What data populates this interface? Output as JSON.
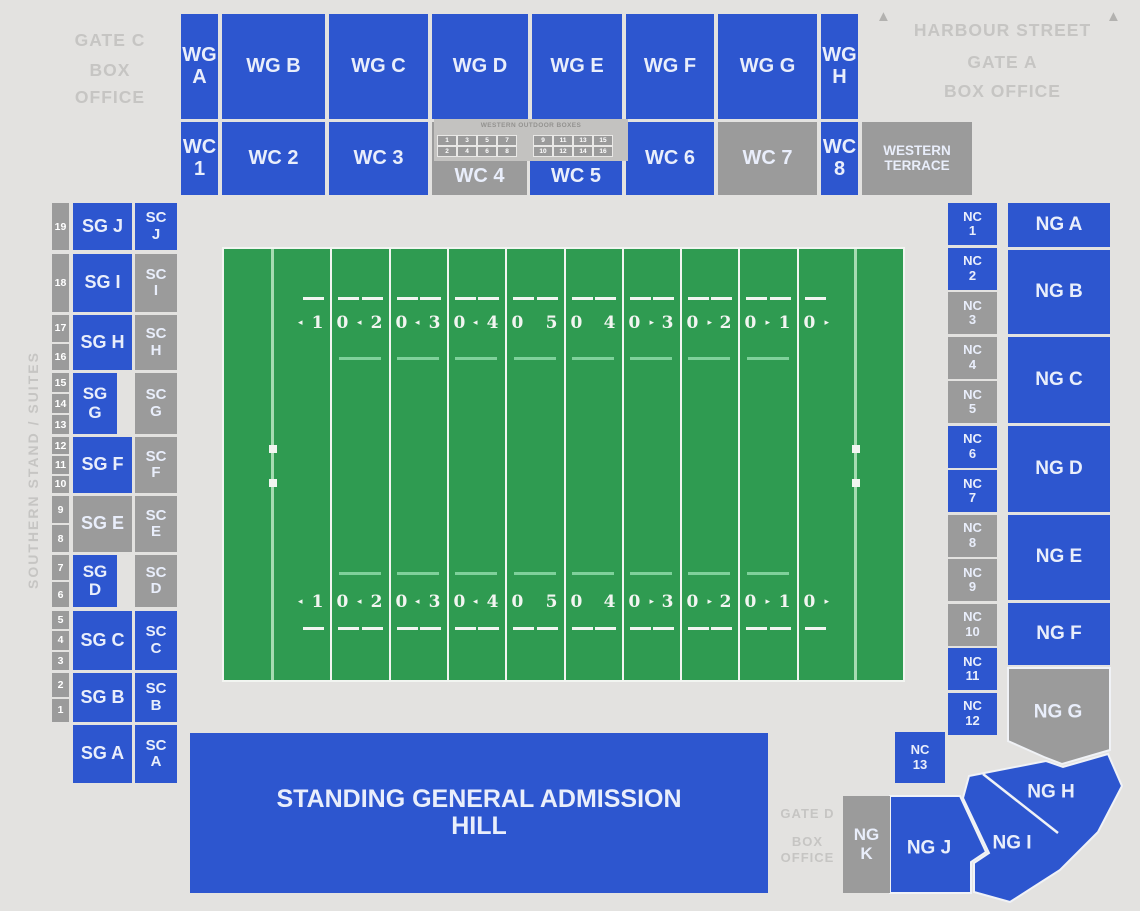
{
  "palette": {
    "available_blue": "#2d56cf",
    "unavailable_gray": "#9b9b9b",
    "background": "#e3e2e0",
    "field_green": "#2f9b51",
    "field_line_white": "#f2f5f1",
    "goal_line_pale": "#a6dcb2",
    "muted_label": "#c6c5c3"
  },
  "gate_c": {
    "line1": "GATE C",
    "line2": "BOX",
    "line3": "OFFICE"
  },
  "harbour": {
    "street": "HARBOUR STREET",
    "gate": "GATE A",
    "box_office": "BOX OFFICE",
    "arrow_glyph": "▲"
  },
  "gate_d": {
    "line1": "GATE D",
    "line2": "BOX",
    "line3": "OFFICE"
  },
  "wg": {
    "a": "WG A",
    "b": "WG B",
    "c": "WG C",
    "d": "WG D",
    "e": "WG E",
    "f": "WG F",
    "g": "WG G",
    "h": "WG H"
  },
  "wc": {
    "c1": "WC 1",
    "c2": "WC 2",
    "c3": "WC 3",
    "c4": "WC 4",
    "c5": "WC 5",
    "c6": "WC 6",
    "c7": "WC 7",
    "c8": "WC 8",
    "terrace": "WESTERN TERRACE",
    "c4_available": false,
    "c7_available": false,
    "terrace_available": false
  },
  "outdoor_boxes": {
    "title": "WESTERN OUTDOOR BOXES",
    "cells_left": [
      "1",
      "3",
      "5",
      "7",
      "2",
      "4",
      "6",
      "8"
    ],
    "cells_right": [
      "9",
      "11",
      "13",
      "15",
      "10",
      "12",
      "14",
      "16"
    ]
  },
  "southern": {
    "side_label": "SOUTHERN STAND / SUITES",
    "rows": [
      {
        "sg": "SG J",
        "sg_available": true,
        "sc": "SC J",
        "sc_available": true,
        "numbers": [
          "19"
        ]
      },
      {
        "sg": "SG I",
        "sg_available": true,
        "sc": "SC I",
        "sc_available": false,
        "numbers": [
          "18"
        ]
      },
      {
        "sg": "SG H",
        "sg_available": true,
        "sc": "SC H",
        "sc_available": false,
        "numbers": [
          "17",
          "16"
        ]
      },
      {
        "sg": "SG G",
        "sg_available": true,
        "sc": "SC G",
        "sc_available": false,
        "numbers": [
          "15",
          "14",
          "13"
        ]
      },
      {
        "sg": "SG F",
        "sg_available": true,
        "sc": "SC F",
        "sc_available": false,
        "numbers": [
          "12",
          "11",
          "10"
        ]
      },
      {
        "sg": "SG E",
        "sg_available": false,
        "sc": "SC E",
        "sc_available": false,
        "numbers": [
          "9",
          "8"
        ]
      },
      {
        "sg": "SG D",
        "sg_available": true,
        "sc": "SC D",
        "sc_available": false,
        "numbers": [
          "7",
          "6"
        ]
      },
      {
        "sg": "SG C",
        "sg_available": true,
        "sc": "SC C",
        "sc_available": true,
        "numbers": [
          "5",
          "4",
          "3"
        ]
      },
      {
        "sg": "SG B",
        "sg_available": true,
        "sc": "SC B",
        "sc_available": true,
        "numbers": [
          "2",
          "1"
        ]
      },
      {
        "sg": "SG A",
        "sg_available": true,
        "sc": "SC A",
        "sc_available": true,
        "numbers": []
      }
    ]
  },
  "field": {
    "numbers": [
      "10",
      "20",
      "30",
      "40",
      "50",
      "40",
      "30",
      "20",
      "10"
    ],
    "arrow_left": "◂",
    "arrow_right": "▸"
  },
  "nc": {
    "cells": [
      {
        "label": "NC 1",
        "available": true
      },
      {
        "label": "NC 2",
        "available": true
      },
      {
        "label": "NC 3",
        "available": false
      },
      {
        "label": "NC 4",
        "available": false
      },
      {
        "label": "NC 5",
        "available": false
      },
      {
        "label": "NC 6",
        "available": true
      },
      {
        "label": "NC 7",
        "available": true
      },
      {
        "label": "NC 8",
        "available": false
      },
      {
        "label": "NC 9",
        "available": false
      },
      {
        "label": "NC 10",
        "available": false
      },
      {
        "label": "NC 11",
        "available": true
      },
      {
        "label": "NC 12",
        "available": true
      }
    ],
    "nc13": {
      "label": "NC 13",
      "available": true
    }
  },
  "ng": {
    "a": "NG A",
    "b": "NG B",
    "c": "NG C",
    "d": "NG D",
    "e": "NG E",
    "f": "NG F",
    "g": "NG G",
    "h": "NG H",
    "i": "NG I",
    "j": "NG J",
    "k": "NG K",
    "g_available": false,
    "k_available": false
  },
  "hill": {
    "label": "STANDING GENERAL ADMISSION HILL"
  }
}
